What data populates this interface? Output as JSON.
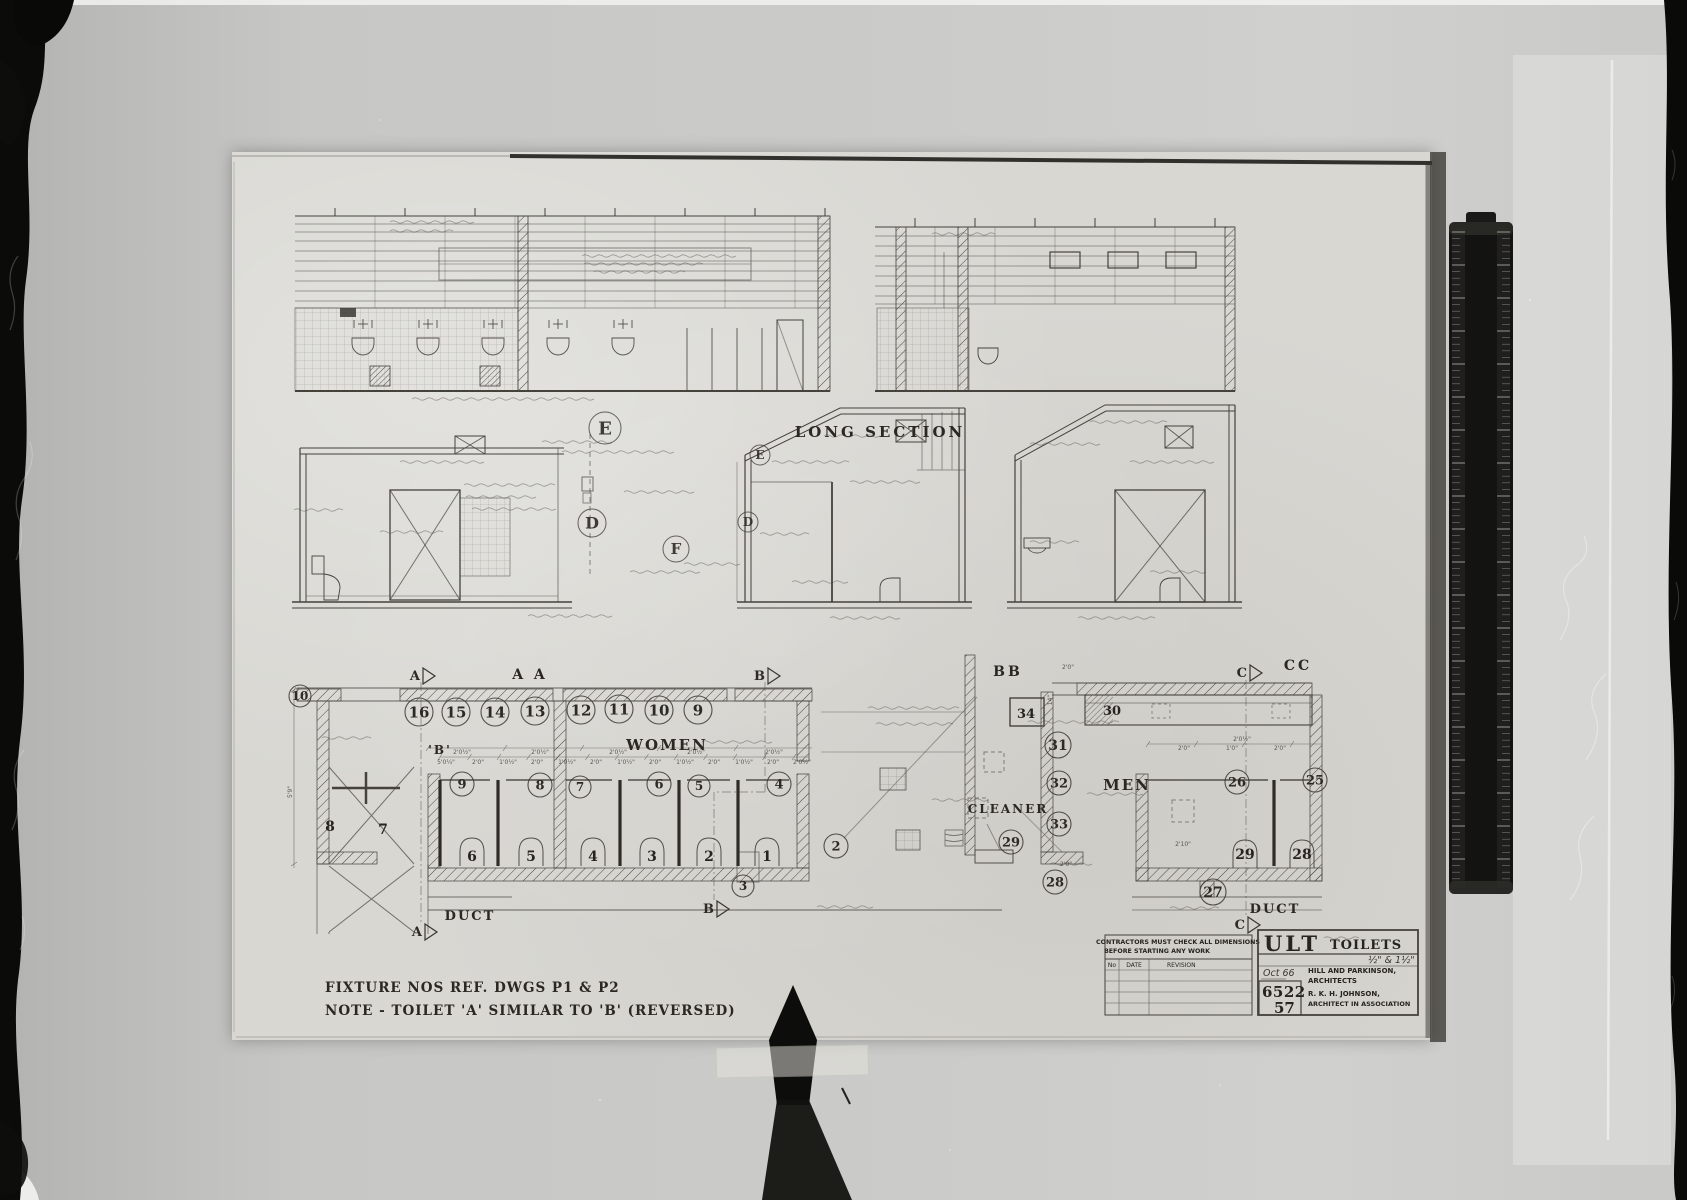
{
  "sheet": {
    "captions": {
      "long_section": "LONG SECTION",
      "aa": "A A",
      "bb": "BB",
      "cc": "CC"
    },
    "rooms": {
      "women": "WOMEN",
      "men": "MEN",
      "cleaner": "CLEANER",
      "duct_left": "DUCT",
      "duct_right": "DUCT",
      "toilet_b": "'B'"
    },
    "notes": {
      "line1": "FIXTURE NOS REF. DWGS P1 & P2",
      "line2": "NOTE - TOILET 'A' SIMILAR TO 'B' (REVERSED)"
    },
    "title_block": {
      "warning1": "CONTRACTORS MUST CHECK ALL DIMENSIONS",
      "warning2": "BEFORE STARTING ANY WORK",
      "rev_no": "No",
      "rev_date": "DATE",
      "rev_revision": "REVISION",
      "code": "ULT",
      "name": "TOILETS",
      "scale_note": "½\" & 1½\"",
      "date_note": "Oct 66",
      "job_no": "6522",
      "sheet_no": "57",
      "firm1": "HILL AND PARKINSON,",
      "firm2": "ARCHITECTS",
      "firm3": "R. K. H. JOHNSON,",
      "firm4": "ARCHITECT IN ASSOCIATION"
    },
    "drawing": {
      "fixture_circles": [
        {
          "t": "16",
          "x": 187,
          "y": 560,
          "r": 14
        },
        {
          "t": "15",
          "x": 224,
          "y": 560,
          "r": 14
        },
        {
          "t": "14",
          "x": 263,
          "y": 560,
          "r": 14
        },
        {
          "t": "13",
          "x": 303,
          "y": 559,
          "r": 14
        },
        {
          "t": "12",
          "x": 349,
          "y": 558,
          "r": 14
        },
        {
          "t": "11",
          "x": 387,
          "y": 557,
          "r": 14
        },
        {
          "t": "10",
          "x": 427,
          "y": 558,
          "r": 14
        },
        {
          "t": "9",
          "x": 466,
          "y": 558,
          "r": 14
        },
        {
          "t": "10",
          "x": 68,
          "y": 544,
          "r": 11
        },
        {
          "t": "9",
          "x": 230,
          "y": 632,
          "r": 12
        },
        {
          "t": "8",
          "x": 308,
          "y": 633,
          "r": 12
        },
        {
          "t": "7",
          "x": 348,
          "y": 635,
          "r": 11
        },
        {
          "t": "6",
          "x": 427,
          "y": 632,
          "r": 12
        },
        {
          "t": "5",
          "x": 467,
          "y": 634,
          "r": 11
        },
        {
          "t": "4",
          "x": 547,
          "y": 632,
          "r": 12
        },
        {
          "t": "2",
          "x": 604,
          "y": 694,
          "r": 12
        },
        {
          "t": "3",
          "x": 511,
          "y": 734,
          "r": 11
        },
        {
          "t": "31",
          "x": 826,
          "y": 593,
          "r": 13
        },
        {
          "t": "32",
          "x": 827,
          "y": 631,
          "r": 12
        },
        {
          "t": "33",
          "x": 827,
          "y": 672,
          "r": 12
        },
        {
          "t": "29",
          "x": 779,
          "y": 690,
          "r": 12
        },
        {
          "t": "26",
          "x": 1005,
          "y": 630,
          "r": 12
        },
        {
          "t": "25",
          "x": 1083,
          "y": 628,
          "r": 12
        },
        {
          "t": "28",
          "x": 823,
          "y": 730,
          "r": 12
        },
        {
          "t": "27",
          "x": 981,
          "y": 740,
          "r": 13
        }
      ],
      "stall_numbers": [
        {
          "t": "6",
          "x": 240,
          "y": 709
        },
        {
          "t": "5",
          "x": 299,
          "y": 709
        },
        {
          "t": "4",
          "x": 361,
          "y": 709
        },
        {
          "t": "3",
          "x": 420,
          "y": 709
        },
        {
          "t": "2",
          "x": 477,
          "y": 709
        },
        {
          "t": "1",
          "x": 535,
          "y": 709
        },
        {
          "t": "29",
          "x": 1013,
          "y": 707
        },
        {
          "t": "28",
          "x": 1070,
          "y": 707
        },
        {
          "t": "8",
          "x": 98,
          "y": 679
        },
        {
          "t": "7",
          "x": 151,
          "y": 682
        }
      ],
      "box_numbers": [
        {
          "t": "34",
          "x": 794,
          "y": 566
        },
        {
          "t": "30",
          "x": 880,
          "y": 563
        }
      ],
      "detail_markers": [
        {
          "t": "E",
          "x": 373,
          "y": 276,
          "r": 16
        },
        {
          "t": "D",
          "x": 360,
          "y": 371,
          "r": 14
        },
        {
          "t": "F",
          "x": 444,
          "y": 397,
          "r": 13
        },
        {
          "t": "E",
          "x": 528,
          "y": 303,
          "r": 10
        },
        {
          "t": "D",
          "x": 516,
          "y": 370,
          "r": 10
        }
      ],
      "section_markers": [
        {
          "t": "A",
          "x": 188,
          "y": 524
        },
        {
          "t": "B",
          "x": 533,
          "y": 524
        },
        {
          "t": "C",
          "x": 1015,
          "y": 521
        },
        {
          "t": "A",
          "x": 190,
          "y": 780
        },
        {
          "t": "B",
          "x": 482,
          "y": 757
        },
        {
          "t": "C",
          "x": 1013,
          "y": 773
        }
      ],
      "dim_labels": [
        {
          "t": "2'0½\"",
          "x": 230,
          "y": 602
        },
        {
          "t": "2'0½\"",
          "x": 308,
          "y": 602
        },
        {
          "t": "2'0½\"",
          "x": 386,
          "y": 602
        },
        {
          "t": "2'0½\"",
          "x": 464,
          "y": 602
        },
        {
          "t": "2'0½\"",
          "x": 542,
          "y": 602
        },
        {
          "t": "5'0¼\"",
          "x": 214,
          "y": 612
        },
        {
          "t": "2'0\"",
          "x": 246,
          "y": 612
        },
        {
          "t": "1'0½\"",
          "x": 276,
          "y": 612
        },
        {
          "t": "2'0\"",
          "x": 305,
          "y": 612
        },
        {
          "t": "1'0½\"",
          "x": 335,
          "y": 612
        },
        {
          "t": "2'0\"",
          "x": 364,
          "y": 612
        },
        {
          "t": "1'0½\"",
          "x": 394,
          "y": 612
        },
        {
          "t": "2'0\"",
          "x": 423,
          "y": 612
        },
        {
          "t": "1'0½\"",
          "x": 453,
          "y": 612
        },
        {
          "t": "2'0\"",
          "x": 482,
          "y": 612
        },
        {
          "t": "1'0½\"",
          "x": 512,
          "y": 612
        },
        {
          "t": "2'0\"",
          "x": 541,
          "y": 612
        },
        {
          "t": "2'0½\"",
          "x": 570,
          "y": 612
        },
        {
          "t": "2'0\"",
          "x": 952,
          "y": 598
        },
        {
          "t": "1'0\"",
          "x": 1000,
          "y": 598
        },
        {
          "t": "2'0\"",
          "x": 1048,
          "y": 598
        },
        {
          "t": "2'0½\"",
          "x": 1010,
          "y": 589
        },
        {
          "t": "2'0\"",
          "x": 836,
          "y": 517
        },
        {
          "t": "14\"",
          "x": 820,
          "y": 548,
          "rot": -90
        },
        {
          "t": "2'0\"",
          "x": 834,
          "y": 714
        },
        {
          "t": "2'10\"",
          "x": 951,
          "y": 694
        },
        {
          "t": "5'9\"",
          "x": 60,
          "y": 640,
          "rot": -90
        }
      ]
    }
  }
}
